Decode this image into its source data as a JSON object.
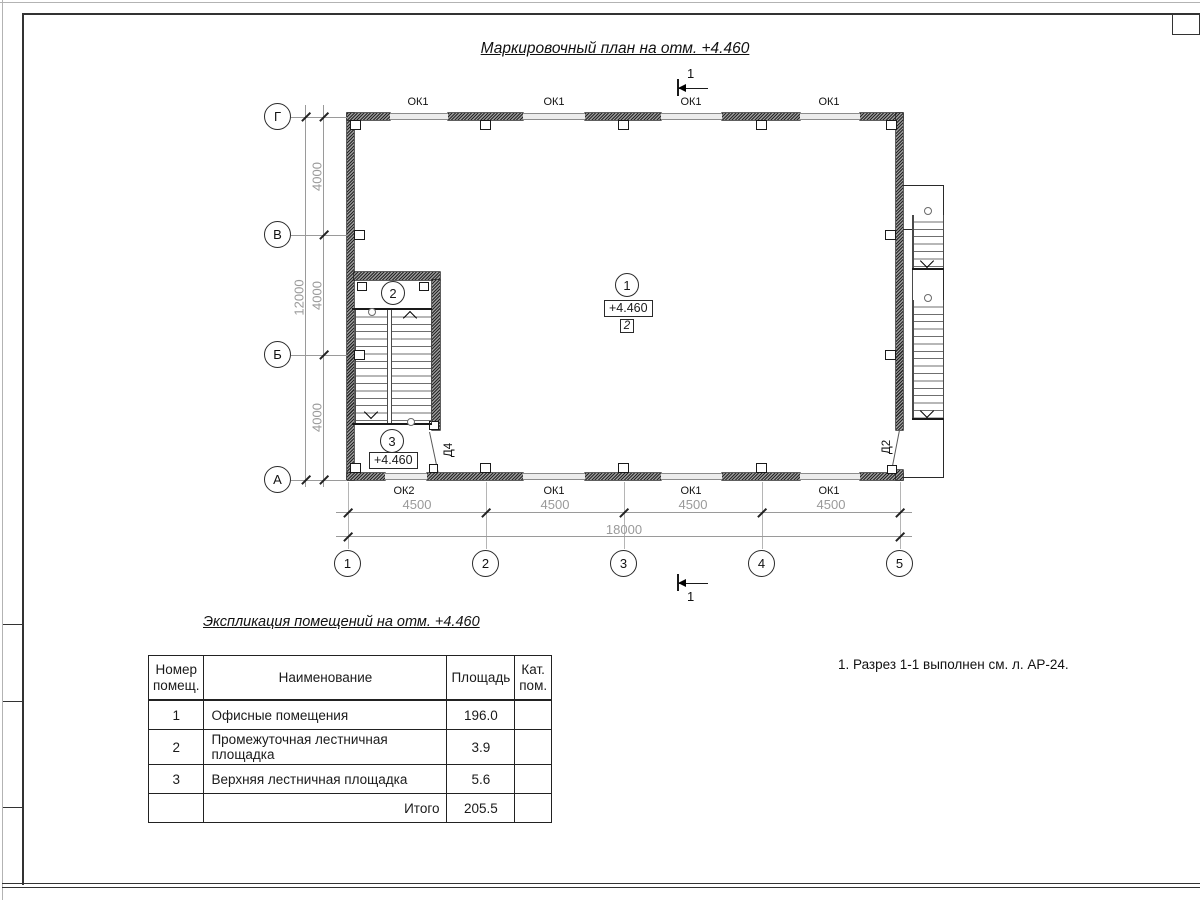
{
  "titles": {
    "plan_title": "Маркировочный план на отм. +4.460",
    "explication_title": "Экспликация помещений на отм. +4.460",
    "note": "1. Разрез 1-1 выполнен см. л. АР-24."
  },
  "plan": {
    "elevation_mark_main": "+4.460",
    "elevation_mark_stair": "+4.460",
    "zone_mark": "2",
    "section_label_top": "1",
    "section_label_bottom": "1",
    "room_marks": {
      "office": "1",
      "mid_landing": "2",
      "upper_landing": "3"
    },
    "windows_top": [
      "ОК1",
      "ОК1",
      "ОК1",
      "ОК1"
    ],
    "windows_bottom": [
      "ОК2",
      "ОК1",
      "ОК1",
      "ОК1"
    ],
    "doors": {
      "stair_door": "Д4",
      "exterior_door": "Д2"
    },
    "grid": {
      "row_labels": [
        "Г",
        "В",
        "Б",
        "А"
      ],
      "col_labels": [
        "1",
        "2",
        "3",
        "4",
        "5"
      ],
      "row_spans": [
        "4000",
        "4000",
        "4000"
      ],
      "row_total": "12000",
      "col_spans": [
        "4500",
        "4500",
        "4500",
        "4500"
      ],
      "col_total": "18000"
    }
  },
  "explication": {
    "headers": {
      "num_l1": "Номер",
      "num_l2": "помещ.",
      "name": "Наименование",
      "area": "Площадь",
      "cat_l1": "Кат.",
      "cat_l2": "пом."
    },
    "rows": [
      {
        "num": "1",
        "name": "Офисные помещения",
        "area": "196.0",
        "cat": ""
      },
      {
        "num": "2",
        "name": "Промежуточная лестничная площадка",
        "area": "3.9",
        "cat": ""
      },
      {
        "num": "3",
        "name": "Верхняя лестничная площадка",
        "area": "5.6",
        "cat": ""
      }
    ],
    "total_label": "Итого",
    "total_area": "205.5"
  },
  "colors": {
    "line": "#1a1a1a",
    "dim_text": "#9a9a9a",
    "wall_hatch": "#262626"
  }
}
